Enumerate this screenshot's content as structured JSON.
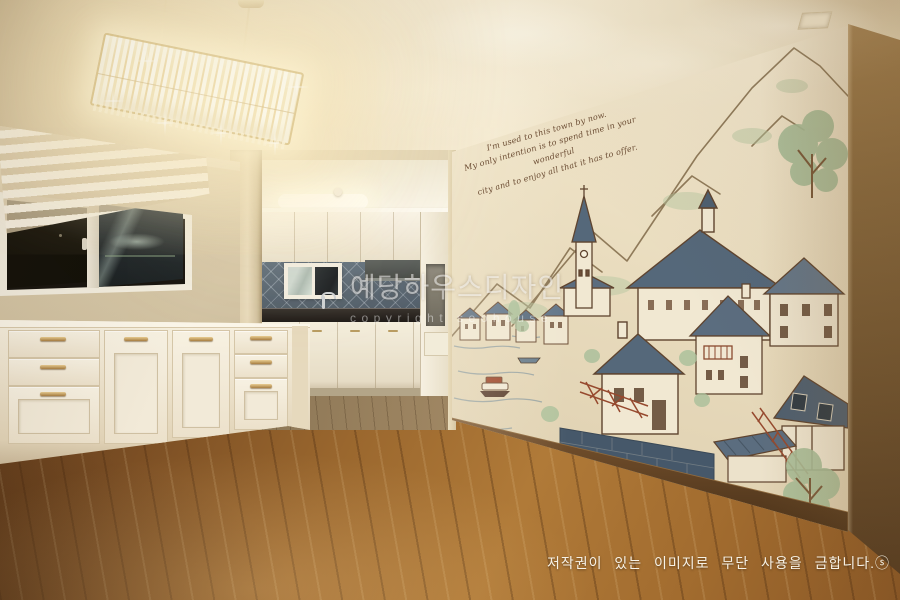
{
  "mural": {
    "quote": {
      "line1": "I'm used to this town by now.",
      "line2": "My only intention is to spend time in your wonderful",
      "line3": "city and to enjoy all that it has to offer."
    }
  },
  "watermark_center": {
    "brand_korean": "예당하우스디자인",
    "brand_english": "copyright seohouse"
  },
  "footer": {
    "notice": "저작권이 있는 이미지로 무단 사용을 금합니다.",
    "mark": "ⓢ"
  },
  "palette": {
    "ceiling": "#ecdfc2",
    "left_wall": "#d8caaa",
    "mural_wall": "#e9ddc2",
    "mural_line": "#6e4f38",
    "mural_roof_slate": "#5b6d7f",
    "mural_tree_green": "#a9bf9a",
    "mural_accent_red": "#9e4a2f",
    "lake_line": "#93a0a2",
    "floor_wood": "#9c6a32",
    "cabinet_white": "#f2e9d6",
    "handle_bronze": "#b98f4e",
    "backsplash_slate": "#5e6c78",
    "countertop_dark": "#2a2522",
    "right_wall_brown": "#7a5a33",
    "chandelier_glow": "#fff3d0"
  }
}
